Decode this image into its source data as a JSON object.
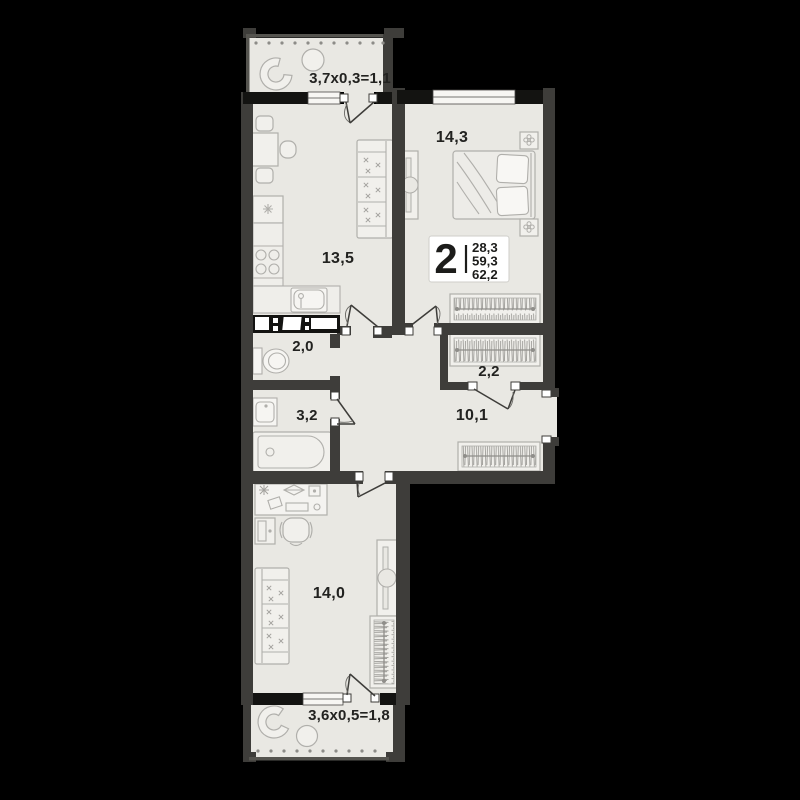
{
  "plan_title": "2-room apartment floor plan",
  "badge": {
    "rooms_count": "2",
    "areas": [
      "28,3",
      "59,3",
      "62,2"
    ]
  },
  "rooms": {
    "balcony_top": {
      "label": "3,7x0,3=1,1"
    },
    "bedroom": {
      "label": "14,3"
    },
    "kitchen_living": {
      "label": "13,5"
    },
    "wc": {
      "label": "2,0"
    },
    "closet": {
      "label": "2,2"
    },
    "bathroom": {
      "label": "3,2"
    },
    "hallway": {
      "label": "10,1"
    },
    "room": {
      "label": "14,0"
    },
    "balcony_bottom": {
      "label": "3,6x0,5=1,8"
    }
  },
  "colors": {
    "background": "#000000",
    "floor": "#e9e8e3",
    "wall": "#3e3d3a",
    "wall_pier": "#131311",
    "furniture_stroke": "#b0afab",
    "label_text": "#222220",
    "badge_background": "#ffffff"
  }
}
